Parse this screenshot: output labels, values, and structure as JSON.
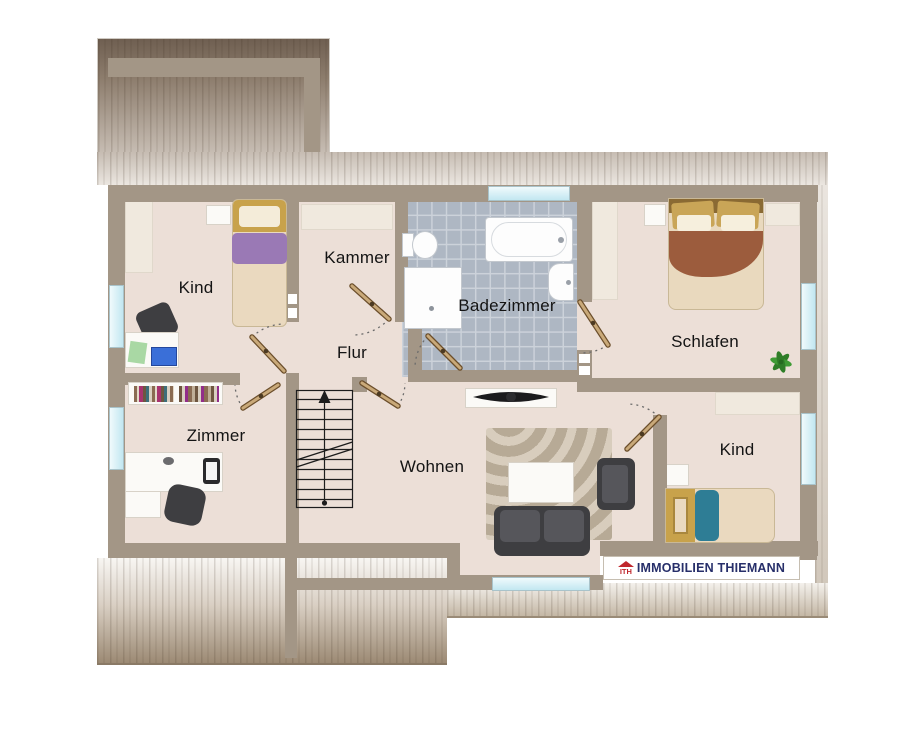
{
  "plan": {
    "title": "Dachgeschoss Grundriss",
    "rooms": {
      "kind_tl": {
        "label": "Kind"
      },
      "kammer": {
        "label": "Kammer"
      },
      "badezimmer": {
        "label": "Badezimmer"
      },
      "schlafen": {
        "label": "Schlafen"
      },
      "flur": {
        "label": "Flur"
      },
      "zimmer": {
        "label": "Zimmer"
      },
      "wohnen": {
        "label": "Wohnen"
      },
      "kind_br": {
        "label": "Kind"
      }
    },
    "branding": {
      "icon_text": "ITH",
      "name": "IMMOBILIEN THIEMANN",
      "logo_red": "#c0272d",
      "logo_navy": "#272f6a"
    },
    "colors": {
      "wall": "#a39686",
      "floor": "#ecdfd7",
      "tiles": "#aeb7c3",
      "window": "#c2e7f1",
      "roof_dark": "#6e5e50",
      "door_wood": "#c9a979"
    }
  }
}
